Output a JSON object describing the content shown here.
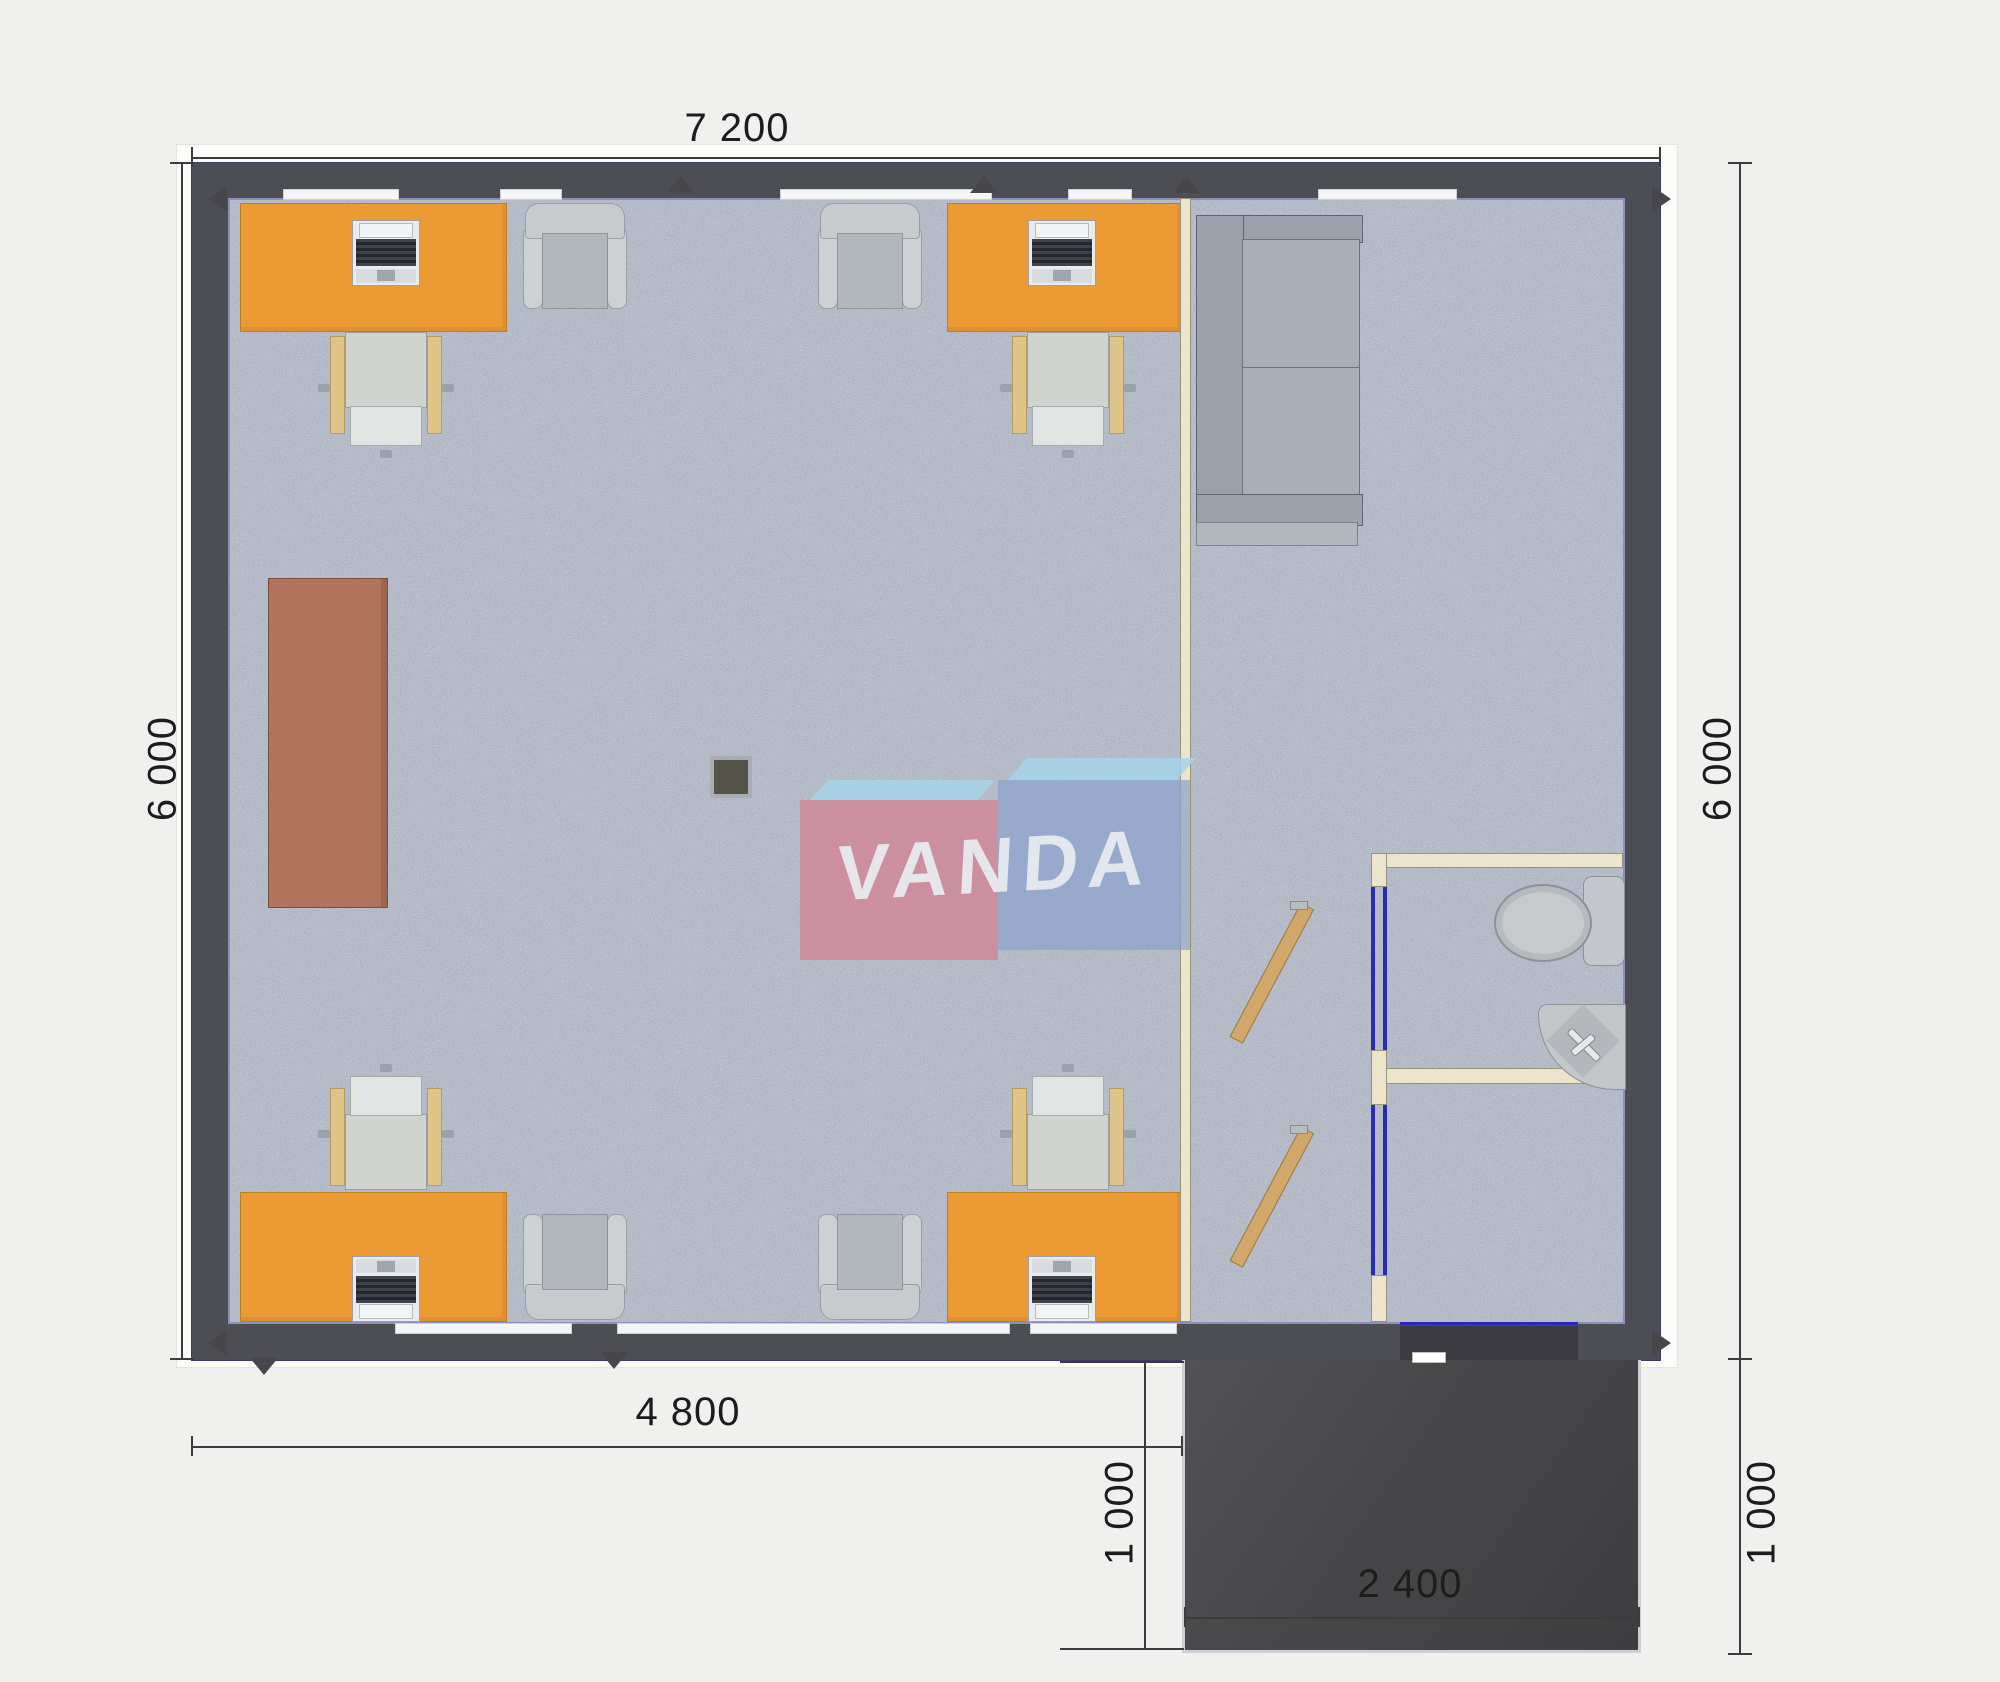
{
  "plan": {
    "title": "modular office floor plan",
    "dimensions": {
      "top_width": "7 200",
      "left_height": "6 000",
      "right_height": "6 000",
      "bottom_main_width": "4 800",
      "porch_depth_left": "1 000",
      "porch_depth_right": "1 000",
      "porch_width": "2 400"
    },
    "watermark": {
      "text": "VANDA"
    },
    "colors": {
      "background": "#f0f0ee",
      "wall_dark": "#4d4e53",
      "floor_speckled": "#bcc2cd",
      "desk_orange": "#ec9b34",
      "cabinet_brown": "#b1735c",
      "partition_beige": "#ece4cb",
      "door_wood": "#d2a86a",
      "door_frame_blue": "#2a2ab8",
      "porch_dark": "#48484b",
      "sofa_gray": "#a3a8b1",
      "logo_pink": "#d4808f",
      "logo_blue": "#8fa6cd",
      "logo_light_blue": "#9fd2e9",
      "dimension_text": "#1c1c1c"
    }
  }
}
